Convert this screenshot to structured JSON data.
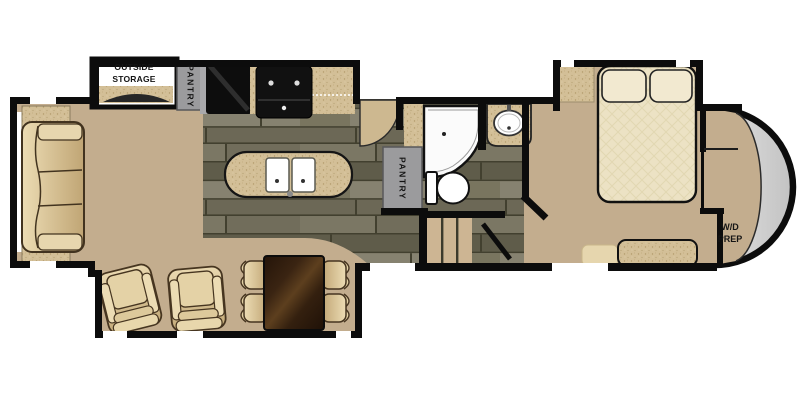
{
  "plan": {
    "type": "rv-fifth-wheel-floorplan",
    "labels": {
      "outside_storage": "OUTSIDE STORAGE",
      "pantry_kitchen": "PANTRY",
      "pantry_hall": "PANTRY",
      "wd_prep": {
        "line1": "W/D",
        "line2": "PREP"
      }
    },
    "fixtures": [
      "sofa-slideout",
      "sofa",
      "end-table",
      "end-table",
      "outside-storage-compartment",
      "pantry-cabinet",
      "refrigerator",
      "range-stove",
      "kitchen-counter",
      "kitchen-island-double-sink",
      "entry-door",
      "corner-shower",
      "bathroom-vanity-sink",
      "toilet",
      "hall-pantry-cabinet",
      "steps-to-bedroom",
      "bedroom-door",
      "bed-with-pillows",
      "nightstand",
      "bench",
      "dresser",
      "wd-prep-closet",
      "rounded-front-cap",
      "living-slideout",
      "recliner",
      "recliner",
      "dining-table",
      "dining-chairs-x4"
    ],
    "colors": {
      "wall": "#0c0c0c",
      "floor_tan": "#c3ad8e",
      "plank_floor": "#6c6856",
      "counter_speckle": "#d3bf97",
      "cabinet_gray": "#9b9b9d",
      "upholstery": "#d9c398",
      "table_wood": "#33200f",
      "bedding": "#ece2c4",
      "front_cap_gray": "#d6d6d6",
      "background": "#ffffff"
    }
  }
}
